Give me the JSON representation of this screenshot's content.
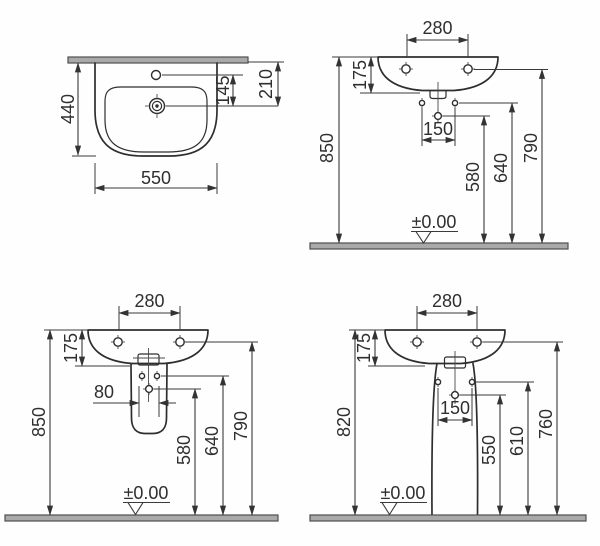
{
  "views": {
    "plan": {
      "overall_width": "550",
      "overall_depth": "440",
      "tap_to_drain": "145",
      "wall_to_drain": "210"
    },
    "wall_hung": {
      "tap_hole_spacing": "280",
      "rim_height": "175",
      "fixing_hole_spacing": "150",
      "drain_height": "580",
      "fixing_height": "640",
      "underside_height": "790",
      "rim_from_floor": "850",
      "floor_datum": "±0.00"
    },
    "semi_pedestal": {
      "tap_hole_spacing": "280",
      "rim_height": "175",
      "bracket_spacing": "80",
      "drain_height": "580",
      "fixing_height": "640",
      "underside_height": "790",
      "rim_from_floor": "850",
      "floor_datum": "±0.00"
    },
    "full_pedestal": {
      "tap_hole_spacing": "280",
      "rim_height": "175",
      "fixing_hole_spacing": "150",
      "drain_height": "550",
      "fixing_height": "610",
      "underside_height": "760",
      "rim_from_floor": "820",
      "floor_datum": "±0.00"
    }
  },
  "colors": {
    "line": "#333333",
    "slab_fill": "#a9a9a9",
    "background": "#fefefe"
  }
}
